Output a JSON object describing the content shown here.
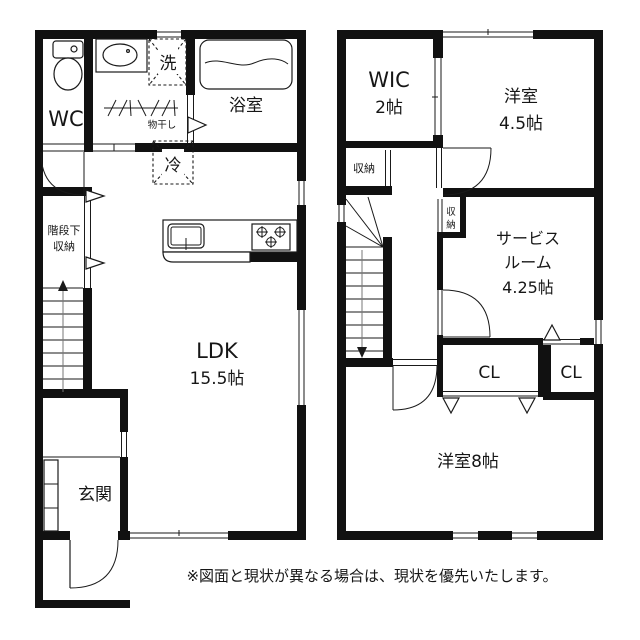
{
  "floor1": {
    "wc": "WC",
    "laundry_machine": "洗",
    "drying_rack": "物干し",
    "bathroom": "浴室",
    "fridge": "冷",
    "understair_line1": "階段下",
    "understair_line2": "収納",
    "ldk_line1": "LDK",
    "ldk_line2": "15.5帖",
    "entrance": "玄関"
  },
  "floor2": {
    "wic_line1": "WIC",
    "wic_line2": "2帖",
    "room45_line1": "洋室",
    "room45_line2": "4.5帖",
    "closet_west": "収納",
    "closet_hall_char1": "収",
    "closet_hall_char2": "納",
    "service_line1": "サービス",
    "service_line2": "ルーム",
    "service_line3": "4.25帖",
    "closet_main": "CL",
    "closet_side": "CL",
    "room8": "洋室8帖"
  },
  "footer": {
    "disclaimer": "※図面と現状が異なる場合は、現状を優先いたします。"
  },
  "colors": {
    "wall": "#111111",
    "line": "#1a1a1a",
    "bg": "#ffffff",
    "soft": "#777777"
  }
}
